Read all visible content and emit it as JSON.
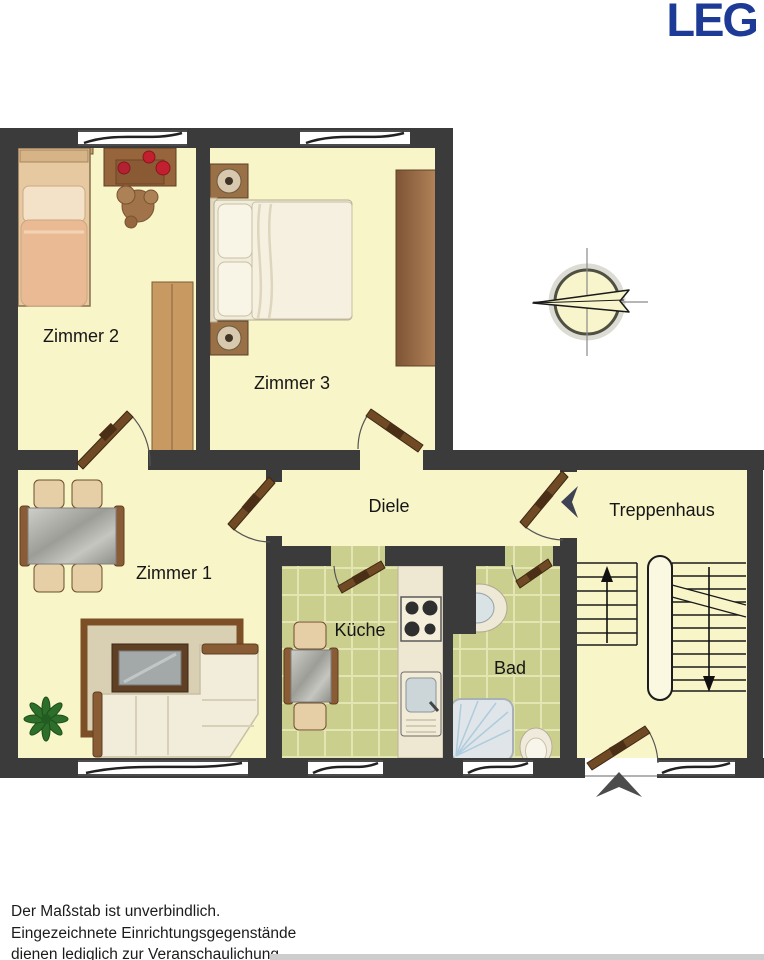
{
  "logo": {
    "text": "LEG",
    "color": "#1d3b96"
  },
  "rooms": {
    "zimmer2": {
      "label": "Zimmer 2"
    },
    "zimmer3": {
      "label": "Zimmer 3"
    },
    "zimmer1": {
      "label": "Zimmer 1"
    },
    "diele": {
      "label": "Diele"
    },
    "kueche": {
      "label": "Küche"
    },
    "bad": {
      "label": "Bad"
    },
    "treppenhaus": {
      "label": "Treppenhaus"
    }
  },
  "footer": {
    "lines": [
      "Der Maßstab ist unverbindlich.",
      "Eingezeichnete Einrichtungsgegenstände",
      "dienen lediglich zur Veranschaulichung."
    ]
  },
  "colors": {
    "wall": "#3b3b3b",
    "floor": "#f8f5c8",
    "tile_floor": "#cbcf8e",
    "logo_blue": "#1d3b96"
  }
}
